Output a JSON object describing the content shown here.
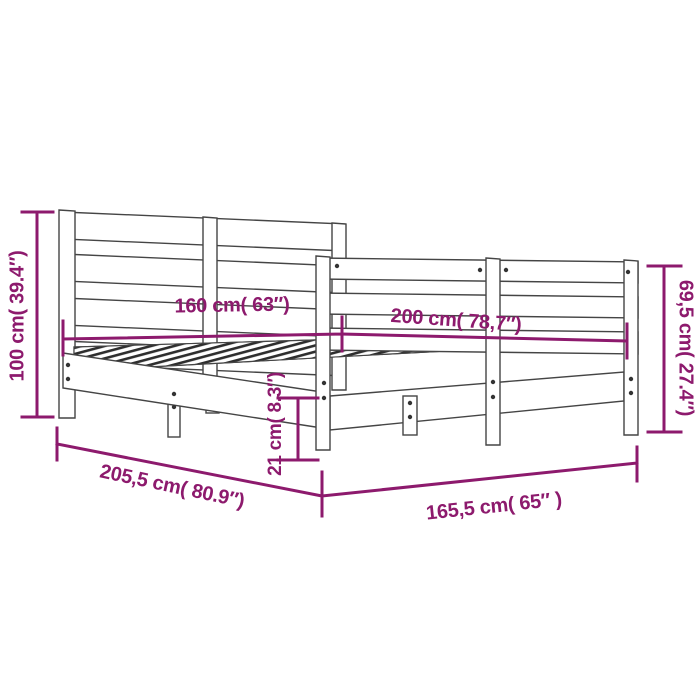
{
  "diagram": {
    "kind": "product-dimension-diagram",
    "subject": "wooden-bed-frame-with-headboard-and-footboard"
  },
  "colors": {
    "dimension_accent": "#8d1a6d",
    "outline": "#454545",
    "background": "#ffffff"
  },
  "dimensions": {
    "headboard_height": {
      "value_cm": "100",
      "value_in": "39.4",
      "label": "100 cm( 39.4″)"
    },
    "mattress_width": {
      "value_cm": "160",
      "value_in": "63",
      "label": "160 cm( 63″)"
    },
    "mattress_length": {
      "value_cm": "200",
      "value_in": "78,7",
      "label": "200 cm( 78,7″)"
    },
    "footboard_height": {
      "value_cm": "69,5",
      "value_in": "27.4",
      "label": "69,5 cm( 27.4″)"
    },
    "rail_height": {
      "value_cm": "21",
      "value_in": "8.3",
      "label": "21 cm( 8.3″)"
    },
    "frame_length": {
      "value_cm": "205,5",
      "value_in": "80.9",
      "label": "205,5 cm( 80.9″)"
    },
    "frame_width": {
      "value_cm": "165,5",
      "value_in": "65",
      "label": "165,5 cm( 65″ )"
    }
  }
}
